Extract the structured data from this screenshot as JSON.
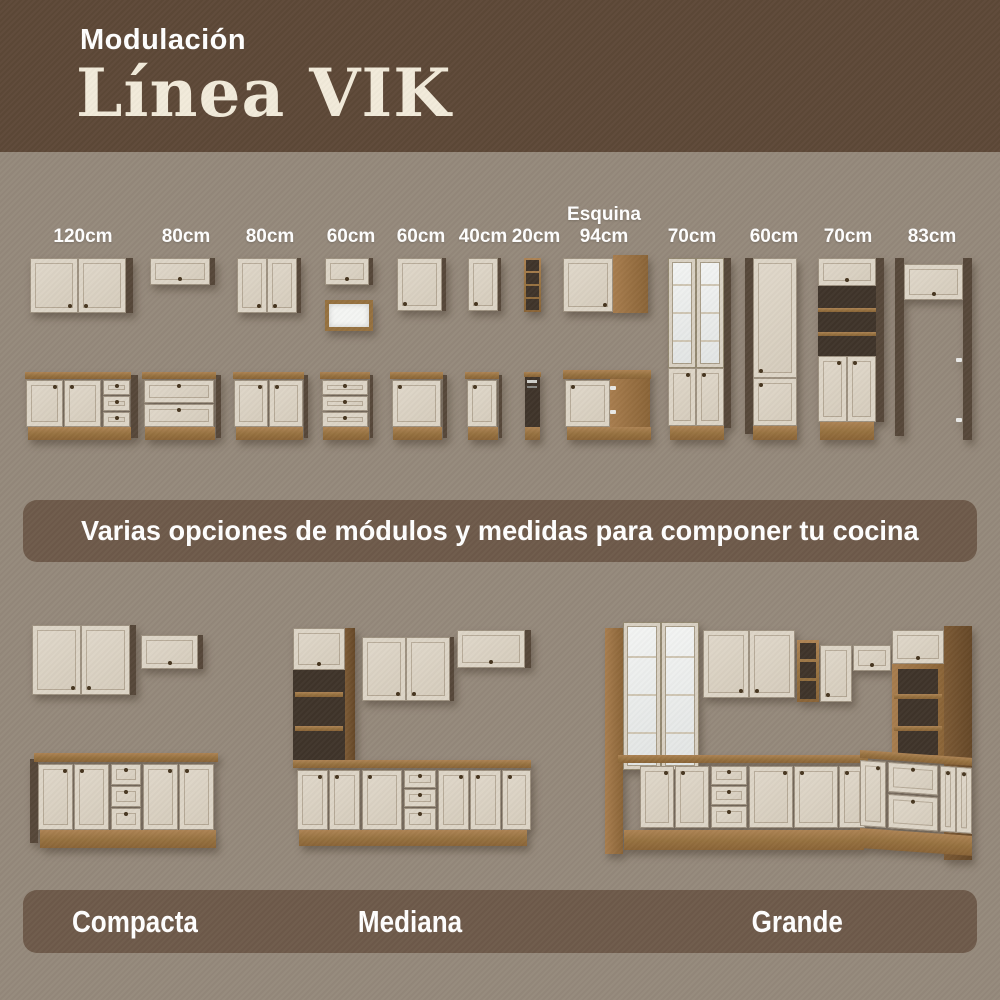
{
  "header": {
    "kicker": "Modulación",
    "title": "Línea VIK"
  },
  "module_labels": [
    {
      "top": "",
      "size": "120cm"
    },
    {
      "top": "",
      "size": "80cm"
    },
    {
      "top": "",
      "size": "80cm"
    },
    {
      "top": "",
      "size": "60cm"
    },
    {
      "top": "",
      "size": "60cm"
    },
    {
      "top": "",
      "size": "40cm"
    },
    {
      "top": "",
      "size": "20cm"
    },
    {
      "top": "Esquina",
      "size": "94cm"
    },
    {
      "top": "",
      "size": "70cm"
    },
    {
      "top": "",
      "size": "60cm"
    },
    {
      "top": "",
      "size": "70cm"
    },
    {
      "top": "",
      "size": "83cm"
    }
  ],
  "banner": {
    "text": "Varias opciones de módulos y medidas para componer tu cocina"
  },
  "sets": [
    {
      "label": "Compacta"
    },
    {
      "label": "Mediana"
    },
    {
      "label": "Grande"
    }
  ],
  "colors": {
    "header_bg": "#5d4837",
    "page_bg": "#95897b",
    "panel_bg": "#6e5a4a",
    "cabinet_cream": "#d9d1c3",
    "wood": "#96713f",
    "title_cream": "#f2ebda",
    "text_light": "#ffffff"
  }
}
